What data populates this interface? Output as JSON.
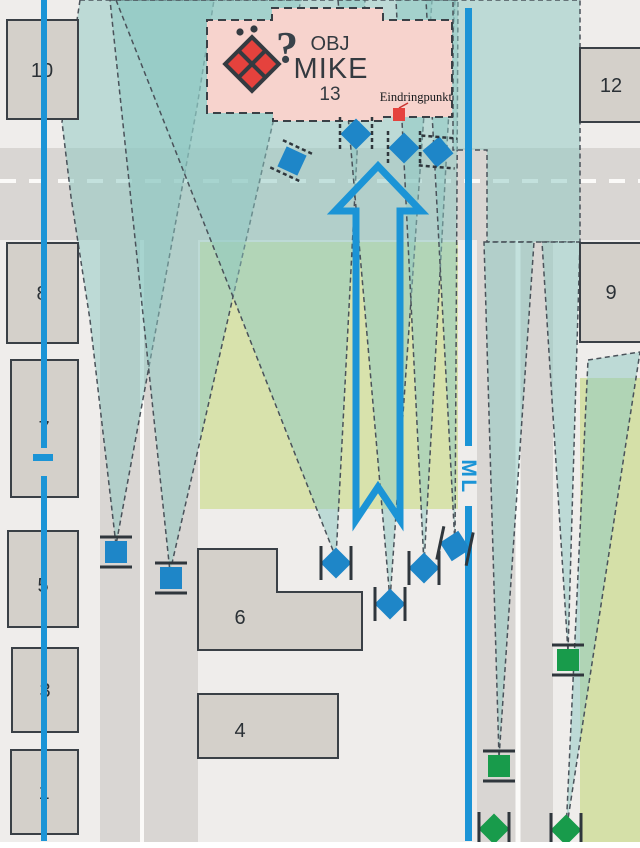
{
  "objective": {
    "prefix": "OBJ",
    "name": "MIKE",
    "number": "13",
    "uncertainty_mark": "?",
    "entry_point_label": "Eindringpunkt"
  },
  "phase_line": {
    "label": "ML"
  },
  "buildings": [
    {
      "label": "10"
    },
    {
      "label": "12"
    },
    {
      "label": "8"
    },
    {
      "label": "9"
    },
    {
      "label": "7"
    },
    {
      "label": "5"
    },
    {
      "label": "3"
    },
    {
      "label": "1"
    },
    {
      "label": "6"
    },
    {
      "label": "4"
    }
  ],
  "symbols": {
    "objective_marker": "red quartered diamond with two dots and question mark",
    "entry_point_marker": "small red square on building edge",
    "assault_arrow": "hollow blue arrow pointing north",
    "blue_units_courtyard_planned": 4,
    "blue_units_street": 6,
    "green_units": 4,
    "sector_overlays": "teal dashed view sectors converging on unit positions"
  },
  "colors": {
    "background": "#efedeb",
    "street_gray": "#d9d6d3",
    "park_green": "#d8e2ac",
    "sector_teal": "#8cc8c2",
    "objective_fill": "#f7d3cd",
    "objective_red": "#e5423d",
    "friendly_blue": "#1b94d6",
    "unit_blue": "#1e86c8",
    "unit_green": "#189b4b",
    "outline_dark": "#3a4046"
  }
}
